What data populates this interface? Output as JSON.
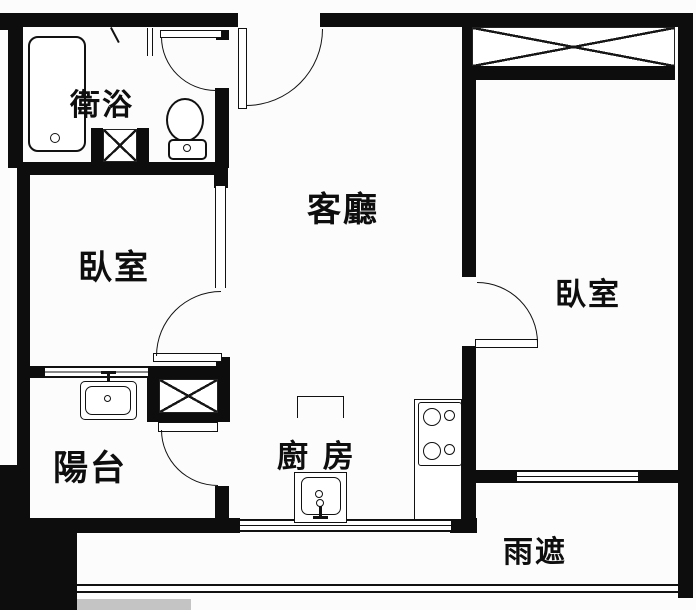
{
  "floorplan": {
    "colors": {
      "wall": "#0d0d0d",
      "line": "#111111",
      "background": "#fcfcfc"
    },
    "rooms": [
      {
        "id": "bathroom",
        "label": "衛浴"
      },
      {
        "id": "bedroom-left",
        "label": "臥室"
      },
      {
        "id": "living-room",
        "label": "客廳"
      },
      {
        "id": "bedroom-right",
        "label": "臥室"
      },
      {
        "id": "balcony",
        "label": "陽台"
      },
      {
        "id": "kitchen",
        "label": "廚 房"
      },
      {
        "id": "rain-shelter",
        "label": "雨遮"
      }
    ]
  }
}
